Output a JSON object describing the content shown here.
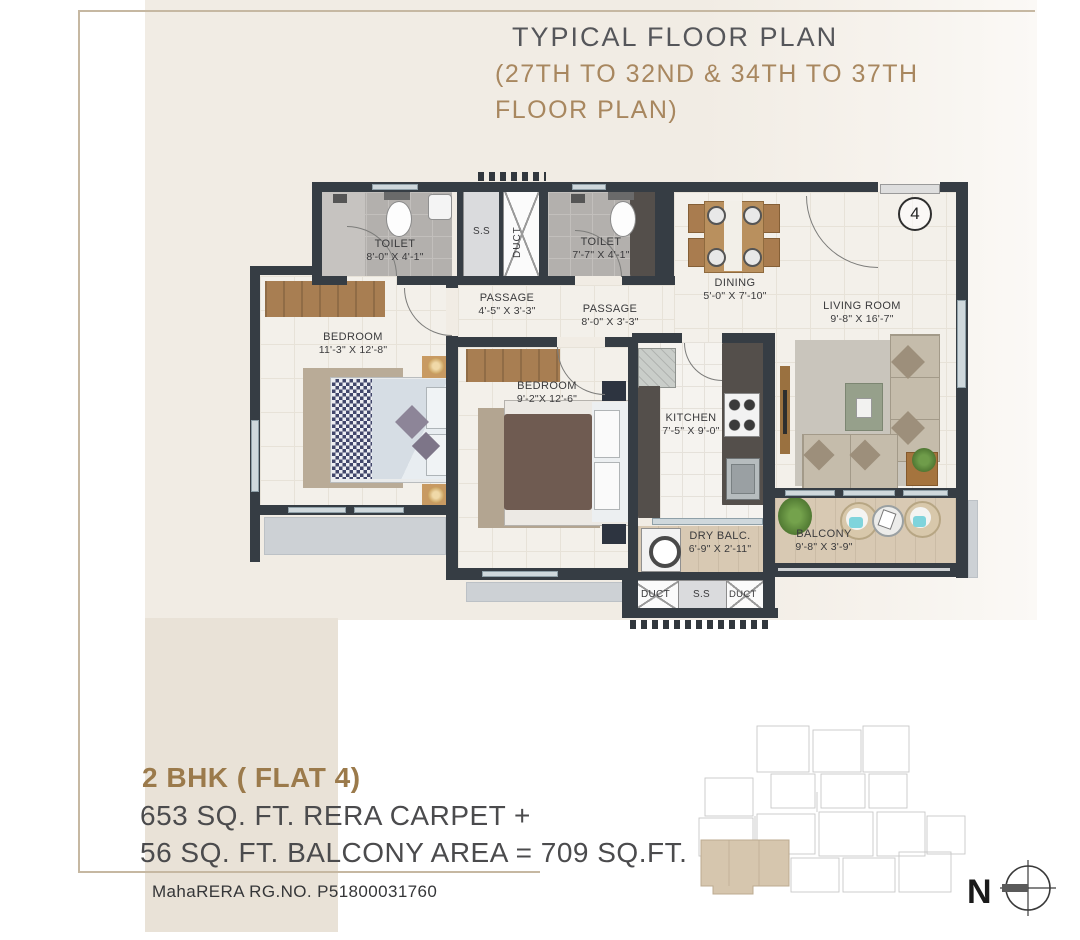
{
  "header": {
    "line1": "TYPICAL FLOOR PLAN",
    "line2": "(27TH TO 32ND & 34TH TO 37TH",
    "line3": "FLOOR PLAN)"
  },
  "plan": {
    "unit_number": "4",
    "rooms": {
      "toilet1": {
        "label": "TOILET",
        "dims": "8'-0\" X 4'-1\""
      },
      "toilet2": {
        "label": "TOILET",
        "dims": "7'-7\" X 4'-1\""
      },
      "passage1": {
        "label": "PASSAGE",
        "dims": "4'-5\" X 3'-3\""
      },
      "passage2": {
        "label": "PASSAGE",
        "dims": "8'-0\" X 3'-3\""
      },
      "dining": {
        "label": "DINING",
        "dims": "5'-0\" X 7'-10\""
      },
      "living": {
        "label": "LIVING ROOM",
        "dims": "9'-8\" X 16'-7\""
      },
      "bedroom1": {
        "label": "BEDROOM",
        "dims": "11'-3\" X 12'-8\""
      },
      "bedroom2": {
        "label": "BEDROOM",
        "dims": "9'-2\"X 12'-6\""
      },
      "kitchen": {
        "label": "KITCHEN",
        "dims": "7'-5\" X 9'-0\""
      },
      "drybalc": {
        "label": "DRY BALC.",
        "dims": "6'-9\" X 2'-11\""
      },
      "balcony": {
        "label": "BALCONY",
        "dims": "9'-8\" X 3'-9\""
      }
    },
    "shafts": {
      "ss_top": "S.S",
      "duct_top": "DUCT",
      "duct_bottom_left": "DUCT",
      "ss_bottom": "S.S",
      "duct_bottom_right": "DUCT"
    }
  },
  "footer": {
    "unit_title": "2 BHK ( FLAT 4)",
    "area_line1": "653 SQ. FT. RERA CARPET +",
    "area_line2": "56 SQ. FT. BALCONY AREA = 709 SQ.FT.",
    "rera_line": "MahaRERA RG.NO.  P51800031760"
  },
  "compass": {
    "north_label": "N"
  },
  "colors": {
    "accent_tan": "#a8875f",
    "heading_brown": "#9b7a4b",
    "wall": "#363d44",
    "cream_bg": "#f1ece4",
    "beige_block": "#e9e2d7"
  }
}
